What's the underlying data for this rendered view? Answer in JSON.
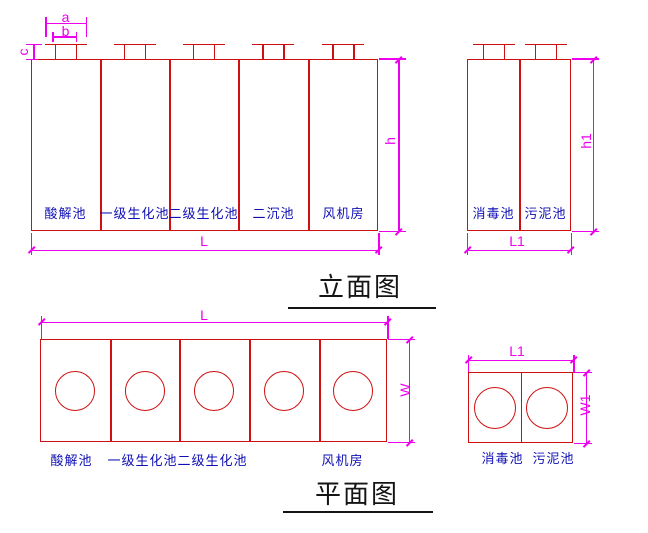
{
  "colors": {
    "line": "#d01010",
    "dimension": "#ee00ee",
    "label": "#0f0fb4",
    "title": "#141414"
  },
  "elevation": {
    "title": "立面图",
    "left_unit": {
      "tanks": [
        "酸解池",
        "一级生化池",
        "二级生化池",
        "二沉池",
        "风机房"
      ],
      "dims": {
        "a": "a",
        "b": "b",
        "c": "c",
        "h": "h",
        "L": "L"
      }
    },
    "right_unit": {
      "tanks": [
        "消毒池",
        "污泥池"
      ],
      "dims": {
        "h1": "h1",
        "L1": "L1"
      }
    }
  },
  "plan": {
    "title": "平面图",
    "left_unit": {
      "labels": [
        "酸解池",
        "一级生化池",
        "二级生化池",
        "风机房"
      ],
      "dims": {
        "L": "L",
        "W": "W"
      }
    },
    "right_unit": {
      "labels": [
        "消毒池",
        "污泥池"
      ],
      "dims": {
        "L1": "L1",
        "W1": "W1"
      }
    }
  }
}
